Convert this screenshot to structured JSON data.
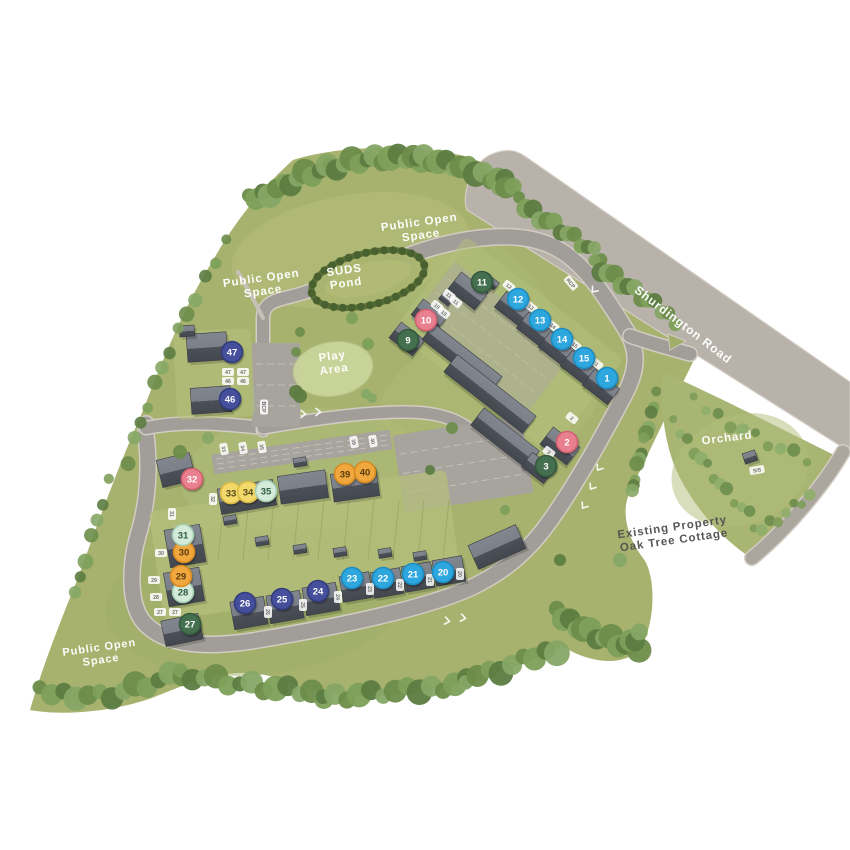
{
  "map": {
    "title": "Development site plan",
    "background": "#ffffff",
    "plot_categories": {
      "blue": {
        "fill": "#2ea7de",
        "stroke": "#1d8cc0",
        "text": "#ffffff"
      },
      "pink": {
        "fill": "#e9808f",
        "stroke": "#d2606f",
        "text": "#ffffff"
      },
      "green": {
        "fill": "#457050",
        "stroke": "#33583d",
        "text": "#ffffff"
      },
      "navy": {
        "fill": "#44509b",
        "stroke": "#323c7c",
        "text": "#ffffff"
      },
      "yellow": {
        "fill": "#f2d96b",
        "stroke": "#d9ba45",
        "text": "#55491c"
      },
      "pale": {
        "fill": "#d5ebda",
        "stroke": "#a5cfb3",
        "text": "#2f5c45"
      },
      "orange": {
        "fill": "#f0a73e",
        "stroke": "#d68c24",
        "text": "#5a3c10"
      }
    },
    "plots": [
      {
        "number": "1",
        "x": 607,
        "y": 378,
        "color": "blue"
      },
      {
        "number": "2",
        "x": 567,
        "y": 442,
        "color": "pink"
      },
      {
        "number": "3",
        "x": 546,
        "y": 466,
        "color": "green"
      },
      {
        "number": "9",
        "x": 408,
        "y": 340,
        "color": "green"
      },
      {
        "number": "10",
        "x": 426,
        "y": 320,
        "color": "pink"
      },
      {
        "number": "11",
        "x": 482,
        "y": 282,
        "color": "green"
      },
      {
        "number": "12",
        "x": 518,
        "y": 299,
        "color": "blue"
      },
      {
        "number": "13",
        "x": 540,
        "y": 320,
        "color": "blue"
      },
      {
        "number": "14",
        "x": 562,
        "y": 339,
        "color": "blue"
      },
      {
        "number": "15",
        "x": 584,
        "y": 358,
        "color": "blue"
      },
      {
        "number": "20",
        "x": 443,
        "y": 572,
        "color": "blue"
      },
      {
        "number": "21",
        "x": 413,
        "y": 574,
        "color": "blue"
      },
      {
        "number": "22",
        "x": 383,
        "y": 578,
        "color": "blue"
      },
      {
        "number": "23",
        "x": 352,
        "y": 578,
        "color": "blue"
      },
      {
        "number": "24",
        "x": 318,
        "y": 591,
        "color": "navy"
      },
      {
        "number": "25",
        "x": 282,
        "y": 599,
        "color": "navy"
      },
      {
        "number": "26",
        "x": 245,
        "y": 603,
        "color": "navy"
      },
      {
        "number": "27",
        "x": 190,
        "y": 624,
        "color": "green"
      },
      {
        "number": "28",
        "x": 183,
        "y": 592,
        "color": "pale"
      },
      {
        "number": "29",
        "x": 181,
        "y": 576,
        "color": "orange"
      },
      {
        "number": "30",
        "x": 184,
        "y": 552,
        "color": "orange"
      },
      {
        "number": "31",
        "x": 183,
        "y": 535,
        "color": "pale"
      },
      {
        "number": "32",
        "x": 192,
        "y": 479,
        "color": "pink"
      },
      {
        "number": "33",
        "x": 231,
        "y": 493,
        "color": "yellow"
      },
      {
        "number": "34",
        "x": 248,
        "y": 492,
        "color": "yellow"
      },
      {
        "number": "35",
        "x": 266,
        "y": 491,
        "color": "pale"
      },
      {
        "number": "39",
        "x": 345,
        "y": 474,
        "color": "orange"
      },
      {
        "number": "40",
        "x": 365,
        "y": 472,
        "color": "orange"
      },
      {
        "number": "46",
        "x": 230,
        "y": 399,
        "color": "navy"
      },
      {
        "number": "47",
        "x": 232,
        "y": 352,
        "color": "navy"
      }
    ],
    "area_labels": [
      {
        "id": "public-open-space-north",
        "lines": [
          "Public Open",
          "Space"
        ],
        "x": 420,
        "y": 228,
        "rot": -8,
        "size": 11.5,
        "color": "#ffffff"
      },
      {
        "id": "public-open-space-west",
        "lines": [
          "Public Open",
          "Space"
        ],
        "x": 262,
        "y": 284,
        "rot": -8,
        "size": 11.5,
        "color": "#ffffff"
      },
      {
        "id": "suds-pond",
        "lines": [
          "SUDS",
          "Pond"
        ],
        "x": 345,
        "y": 276,
        "rot": -8,
        "size": 11.5,
        "color": "#ffffff"
      },
      {
        "id": "play-area",
        "lines": [
          "Play",
          "Area"
        ],
        "x": 333,
        "y": 362,
        "rot": -8,
        "size": 11.5,
        "color": "#ffffff"
      },
      {
        "id": "public-open-space-south",
        "lines": [
          "Public Open",
          "Space"
        ],
        "x": 100,
        "y": 653,
        "rot": -8,
        "size": 11,
        "color": "#ffffff"
      },
      {
        "id": "shurdington-road",
        "lines": [
          "Shurdington Road"
        ],
        "x": 683,
        "y": 325,
        "rot": 37.5,
        "size": 12,
        "color": "#ffffff"
      },
      {
        "id": "orchard",
        "lines": [
          "Orchard"
        ],
        "x": 727,
        "y": 438,
        "rot": -7,
        "size": 11.5,
        "color": "#ffffff"
      },
      {
        "id": "existing-property",
        "lines": [
          "Existing Property",
          "Oak Tree Cottage"
        ],
        "x": 673,
        "y": 533,
        "rot": -8,
        "size": 11.5,
        "color": "#525252"
      }
    ],
    "parking_labels": [
      {
        "t": "11",
        "x": 449,
        "y": 295,
        "r": 38
      },
      {
        "t": "11",
        "x": 456,
        "y": 302,
        "r": 38
      },
      {
        "t": "10",
        "x": 437,
        "y": 306,
        "r": 38
      },
      {
        "t": "10",
        "x": 444,
        "y": 313,
        "r": 38
      },
      {
        "t": "12",
        "x": 509,
        "y": 286,
        "r": 38
      },
      {
        "t": "13",
        "x": 531,
        "y": 307,
        "r": 38
      },
      {
        "t": "14",
        "x": 553,
        "y": 326,
        "r": 38
      },
      {
        "t": "15",
        "x": 575,
        "y": 345,
        "r": 38
      },
      {
        "t": "1",
        "x": 597,
        "y": 364,
        "r": 38
      },
      {
        "t": "2",
        "x": 572,
        "y": 418,
        "r": 38
      },
      {
        "t": "3",
        "x": 549,
        "y": 452,
        "r": 38
      },
      {
        "t": "47",
        "x": 228,
        "y": 372,
        "r": 0
      },
      {
        "t": "47",
        "x": 243,
        "y": 372,
        "r": 0
      },
      {
        "t": "46",
        "x": 228,
        "y": 381,
        "r": 0
      },
      {
        "t": "46",
        "x": 243,
        "y": 381,
        "r": 0
      },
      {
        "t": "31",
        "x": 172,
        "y": 514,
        "r": 90
      },
      {
        "t": "30",
        "x": 161,
        "y": 553,
        "r": 0
      },
      {
        "t": "29",
        "x": 154,
        "y": 580,
        "r": 0
      },
      {
        "t": "28",
        "x": 156,
        "y": 597,
        "r": 0
      },
      {
        "t": "27",
        "x": 160,
        "y": 612,
        "r": 0
      },
      {
        "t": "27",
        "x": 175,
        "y": 612,
        "r": 0
      },
      {
        "t": "32",
        "x": 213,
        "y": 499,
        "r": 90
      },
      {
        "t": "33",
        "x": 224,
        "y": 449,
        "r": 80
      },
      {
        "t": "34",
        "x": 243,
        "y": 448,
        "r": 80
      },
      {
        "t": "35",
        "x": 262,
        "y": 447,
        "r": 80
      },
      {
        "t": "39",
        "x": 354,
        "y": 442,
        "r": 80
      },
      {
        "t": "40",
        "x": 373,
        "y": 441,
        "r": 80
      },
      {
        "t": "26",
        "x": 268,
        "y": 612,
        "r": 90
      },
      {
        "t": "25",
        "x": 303,
        "y": 605,
        "r": 90
      },
      {
        "t": "24",
        "x": 338,
        "y": 597,
        "r": 90
      },
      {
        "t": "23",
        "x": 370,
        "y": 589,
        "r": 90
      },
      {
        "t": "22",
        "x": 400,
        "y": 585,
        "r": 90
      },
      {
        "t": "21",
        "x": 430,
        "y": 580,
        "r": 90
      },
      {
        "t": "20",
        "x": 460,
        "y": 574,
        "r": 90
      },
      {
        "t": "BCP",
        "x": 264,
        "y": 407,
        "r": 90
      },
      {
        "t": "RCP",
        "x": 571,
        "y": 283,
        "r": 50
      },
      {
        "t": "S/S",
        "x": 757,
        "y": 470,
        "r": -10
      }
    ]
  }
}
